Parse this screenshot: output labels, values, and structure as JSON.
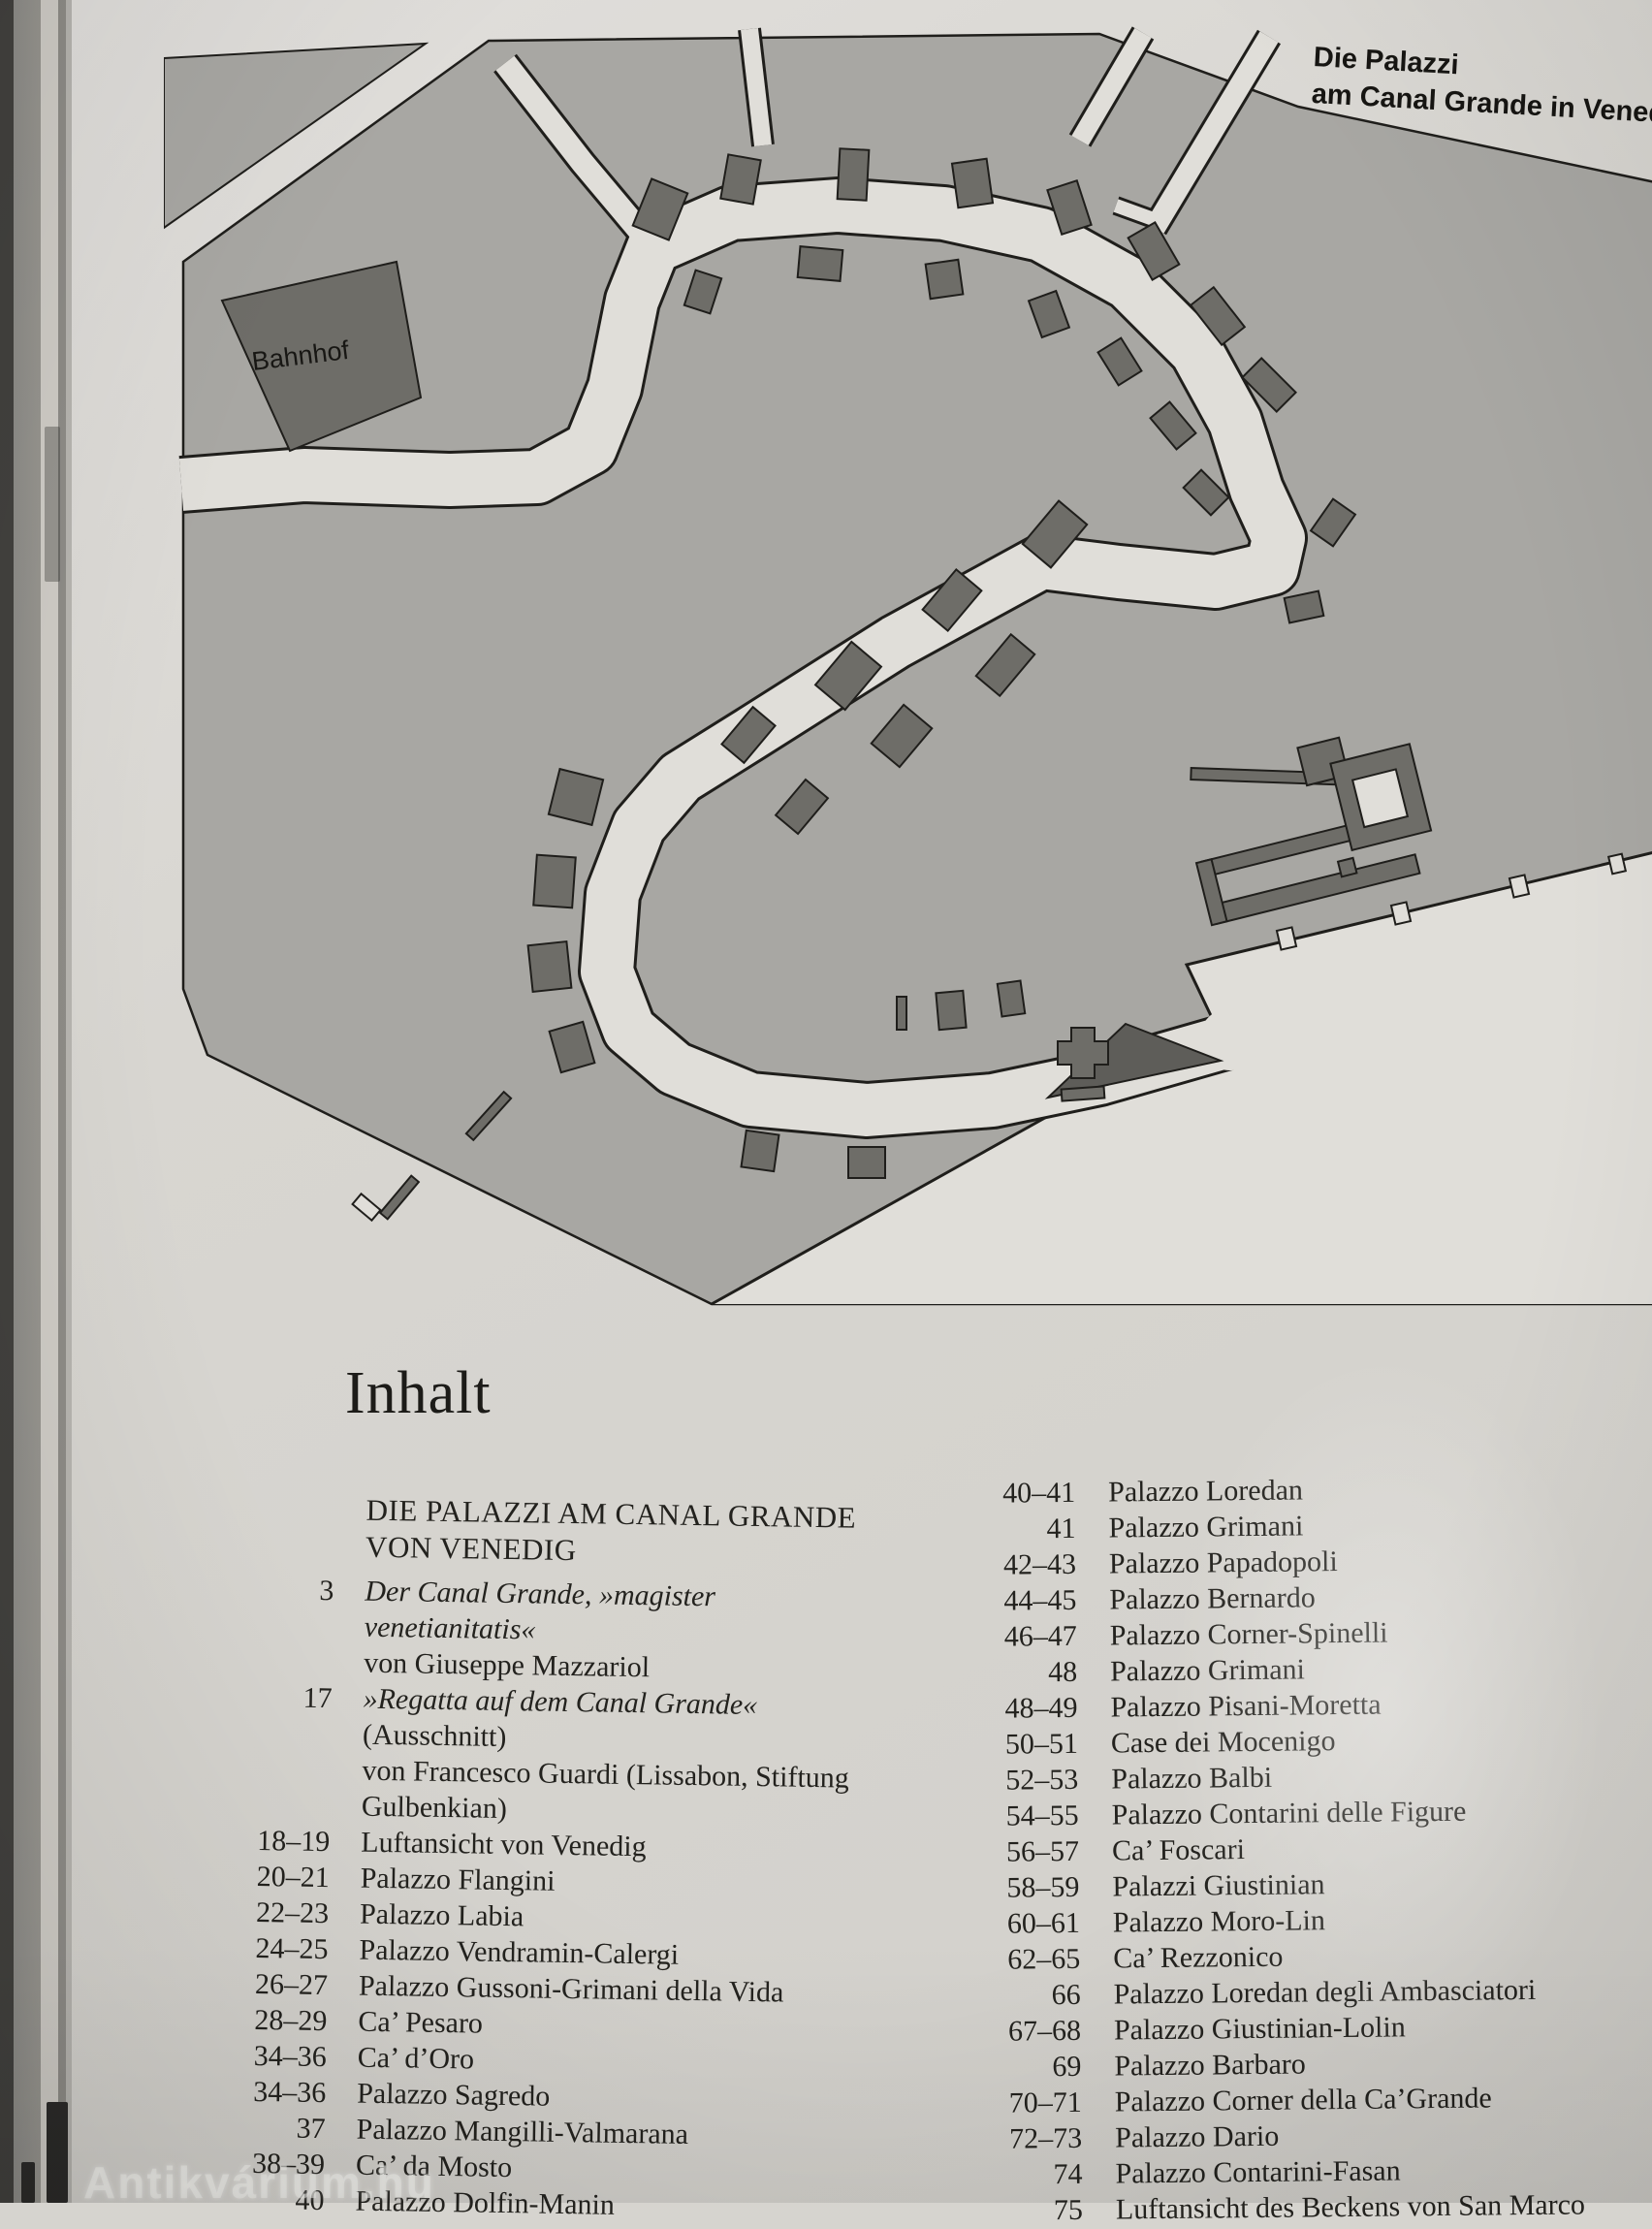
{
  "colors": {
    "page_bg": "#d6d4cf",
    "land": "#a8a7a3",
    "water": "#e0ded9",
    "building": "#6e6d68",
    "ink": "#1f1e1b"
  },
  "map": {
    "title_line1": "Die Palazzi",
    "title_line2": "am Canal Grande in Venedig",
    "station_label": "Bahnhof"
  },
  "toc": {
    "heading": "Inhalt",
    "section_title_line1": "DIE PALAZZI AM CANAL GRANDE",
    "section_title_line2": "VON VENEDIG",
    "left_entries": [
      {
        "pages": "3",
        "lines": [
          {
            "text": "Der Canal Grande, »magister",
            "italic": true
          },
          {
            "text": "venetianitatis«",
            "italic": true
          },
          {
            "text": "von Giuseppe Mazzariol",
            "italic": false
          }
        ]
      },
      {
        "pages": "17",
        "lines": [
          {
            "text": "»Regatta auf dem Canal Grande«",
            "italic": true
          },
          {
            "text": "(Ausschnitt)",
            "italic": false
          },
          {
            "text": "von Francesco Guardi (Lissabon, Stiftung",
            "italic": false
          },
          {
            "text": "Gulbenkian)",
            "italic": false
          }
        ]
      },
      {
        "pages": "18–19",
        "lines": [
          {
            "text": "Luftansicht von Venedig",
            "italic": false
          }
        ]
      },
      {
        "pages": "20–21",
        "lines": [
          {
            "text": "Palazzo Flangini",
            "italic": false
          }
        ]
      },
      {
        "pages": "22–23",
        "lines": [
          {
            "text": "Palazzo Labia",
            "italic": false
          }
        ]
      },
      {
        "pages": "24–25",
        "lines": [
          {
            "text": "Palazzo Vendramin-Calergi",
            "italic": false
          }
        ]
      },
      {
        "pages": "26–27",
        "lines": [
          {
            "text": "Palazzo Gussoni-Grimani della Vida",
            "italic": false
          }
        ]
      },
      {
        "pages": "28–29",
        "lines": [
          {
            "text": "Ca’ Pesaro",
            "italic": false
          }
        ]
      },
      {
        "pages": "34–36",
        "lines": [
          {
            "text": "Ca’ d’Oro",
            "italic": false
          }
        ]
      },
      {
        "pages": "34–36",
        "lines": [
          {
            "text": "Palazzo Sagredo",
            "italic": false
          }
        ]
      },
      {
        "pages": "37",
        "lines": [
          {
            "text": "Palazzo Mangilli-Valmarana",
            "italic": false
          }
        ]
      },
      {
        "pages": "38–39",
        "lines": [
          {
            "text": "Ca’ da Mosto",
            "italic": false
          }
        ]
      },
      {
        "pages": "40",
        "lines": [
          {
            "text": "Palazzo Dolfin-Manin",
            "italic": false
          }
        ]
      }
    ],
    "right_entries": [
      {
        "pages": "40–41",
        "title": "Palazzo Loredan"
      },
      {
        "pages": "41",
        "title": "Palazzo Grimani"
      },
      {
        "pages": "42–43",
        "title": "Palazzo Papadopoli"
      },
      {
        "pages": "44–45",
        "title": "Palazzo Bernardo"
      },
      {
        "pages": "46–47",
        "title": "Palazzo Corner-Spinelli"
      },
      {
        "pages": "48",
        "title": "Palazzo Grimani"
      },
      {
        "pages": "48–49",
        "title": "Palazzo Pisani-Moretta"
      },
      {
        "pages": "50–51",
        "title": "Case dei Mocenigo"
      },
      {
        "pages": "52–53",
        "title": "Palazzo Balbi"
      },
      {
        "pages": "54–55",
        "title": "Palazzo Contarini delle Figure"
      },
      {
        "pages": "56–57",
        "title": "Ca’ Foscari"
      },
      {
        "pages": "58–59",
        "title": "Palazzi Giustinian"
      },
      {
        "pages": "60–61",
        "title": "Palazzo Moro-Lin"
      },
      {
        "pages": "62–65",
        "title": "Ca’ Rezzonico"
      },
      {
        "pages": "66",
        "title": "Palazzo Loredan degli Ambasciatori"
      },
      {
        "pages": "67–68",
        "title": "Palazzo Giustinian-Lolin"
      },
      {
        "pages": "69",
        "title": "Palazzo Barbaro"
      },
      {
        "pages": "70–71",
        "title": "Palazzo Corner della Ca’Grande"
      },
      {
        "pages": "72–73",
        "title": "Palazzo Dario"
      },
      {
        "pages": "74",
        "title": "Palazzo Contarini-Fasan"
      },
      {
        "pages": "75",
        "title": "Luftansicht des Beckens von San Marco"
      }
    ]
  },
  "watermark": "Antikvárium.hu"
}
